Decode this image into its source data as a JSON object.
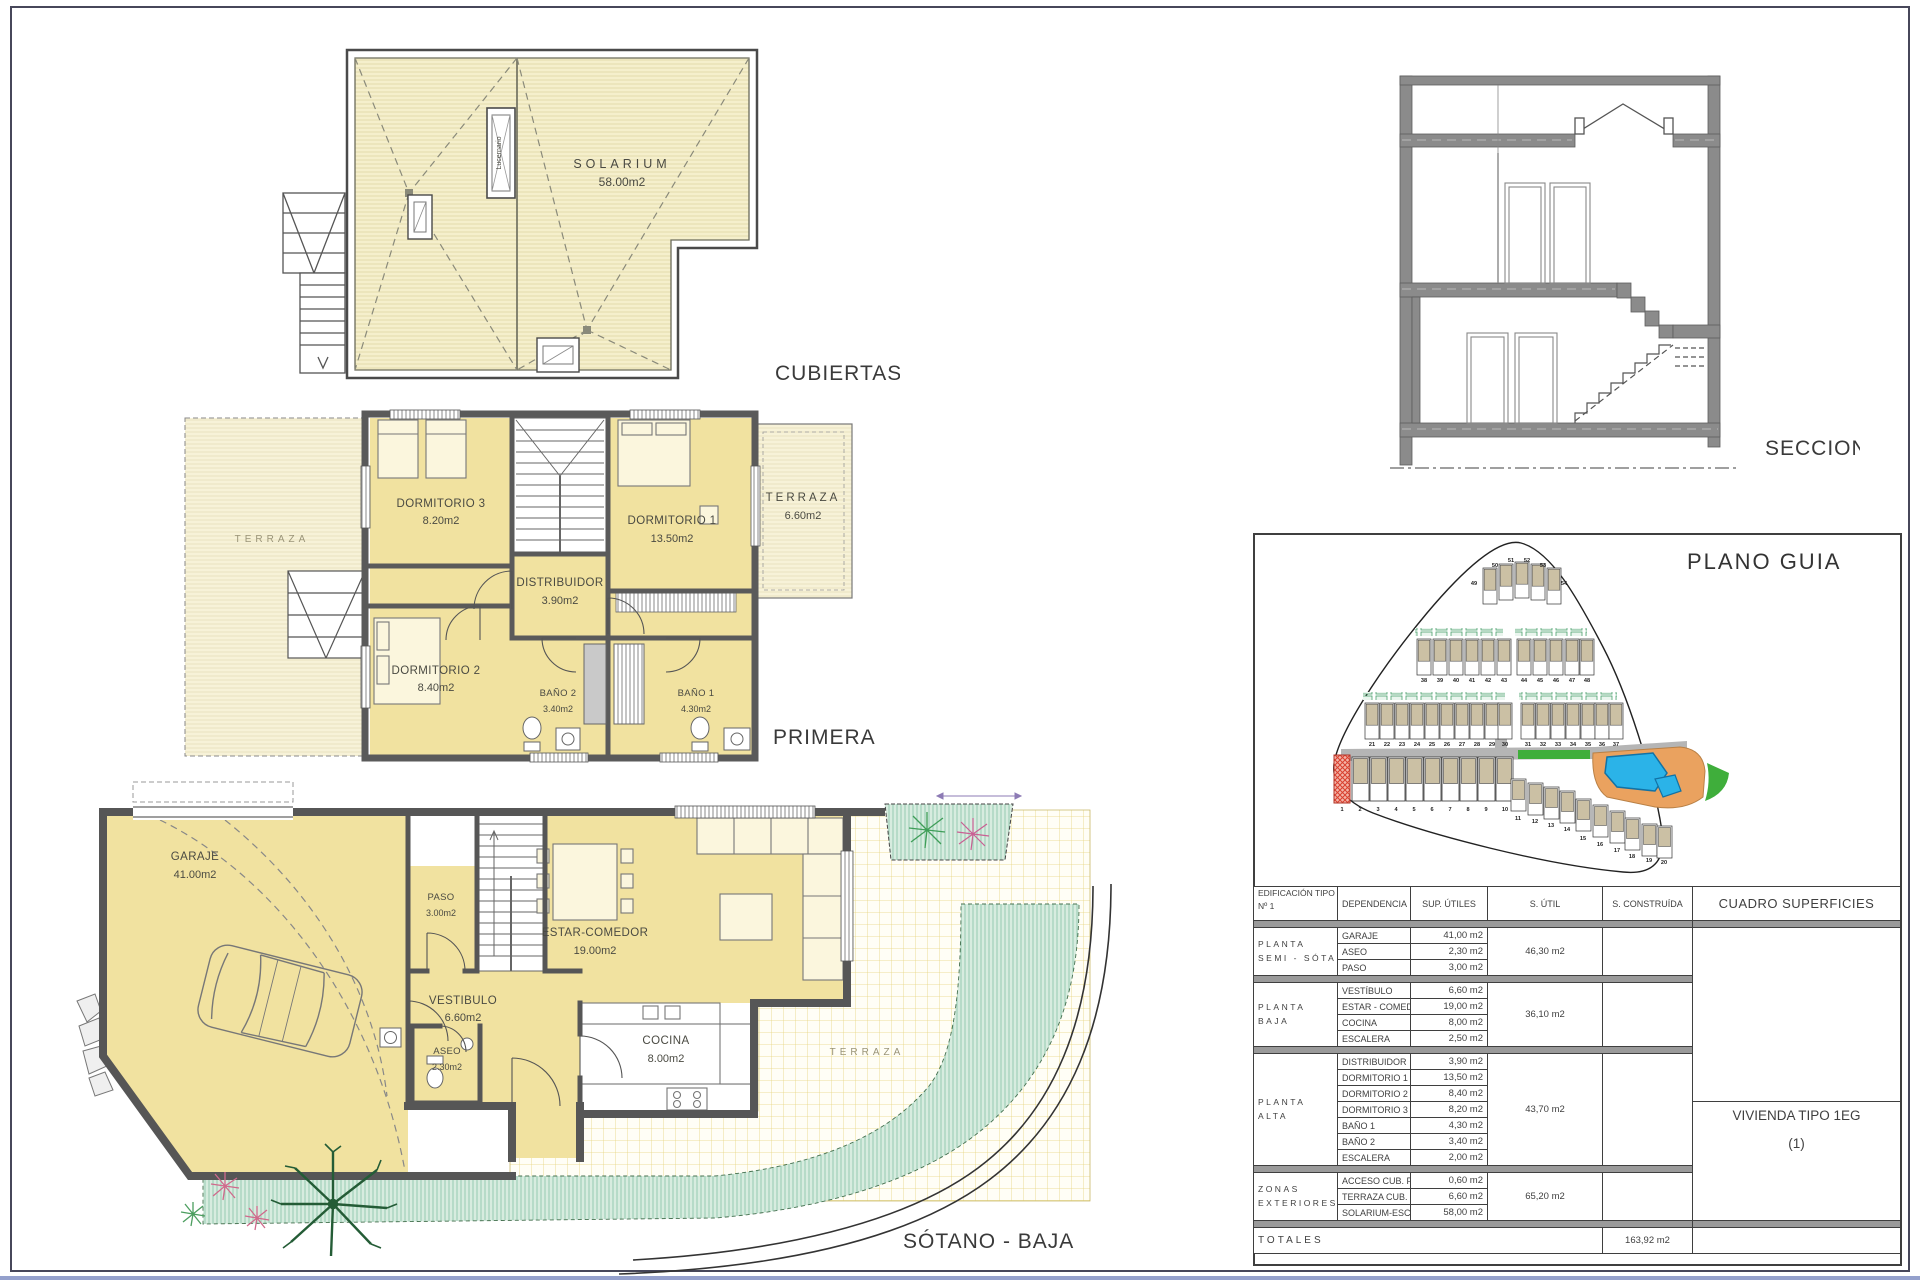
{
  "plans": {
    "cubiertas": {
      "label": "CUBIERTAS",
      "solarium": {
        "name": "SOLARIUM",
        "area": "58.00m2"
      },
      "skylight": "Lucernario"
    },
    "primera": {
      "label": "PRIMERA",
      "terraza_izq": "TERRAZA",
      "rooms": [
        {
          "name": "DORMITORIO 3",
          "area": "8.20m2"
        },
        {
          "name": "DORMITORIO 1",
          "area": "13.50m2"
        },
        {
          "name": "TERRAZA",
          "area": "6.60m2"
        },
        {
          "name": "DISTRIBUIDOR",
          "area": "3.90m2"
        },
        {
          "name": "DORMITORIO 2",
          "area": "8.40m2"
        },
        {
          "name": "BAÑO 2",
          "area": "3.40m2"
        },
        {
          "name": "BAÑO 1",
          "area": "4.30m2"
        }
      ]
    },
    "sotano_baja": {
      "label": "SÓTANO - BAJA",
      "terraza": "TERRAZA",
      "rooms": [
        {
          "name": "GARAJE",
          "area": "41.00m2"
        },
        {
          "name": "PASO",
          "area": "3.00m2"
        },
        {
          "name": "ESTAR-COMEDOR",
          "area": "19.00m2"
        },
        {
          "name": "VESTIBULO",
          "area": "6.60m2"
        },
        {
          "name": "ASEO",
          "area": "2.30m2"
        },
        {
          "name": "COCINA",
          "area": "8.00m2"
        }
      ]
    },
    "seccion": {
      "label": "SECCION"
    }
  },
  "plano_guia": {
    "title": "PLANO GUIA",
    "lots": [
      "1",
      "2",
      "3",
      "4",
      "5",
      "6",
      "7",
      "8",
      "9",
      "10",
      "11",
      "12",
      "13",
      "14",
      "15",
      "16",
      "17",
      "18",
      "19",
      "20",
      "21",
      "22",
      "23",
      "24",
      "25",
      "26",
      "27",
      "28",
      "29",
      "30",
      "31",
      "32",
      "33",
      "34",
      "35",
      "36",
      "37",
      "38",
      "39",
      "40",
      "41",
      "42",
      "43",
      "44",
      "45",
      "46",
      "47",
      "48",
      "49",
      "50",
      "51",
      "52",
      "53",
      "54"
    ]
  },
  "table": {
    "headers": {
      "edificacion_line1": "EDIFICACIÓN TIPO 1EG",
      "edificacion_line2": "Nº 1",
      "dependencia": "DEPENDENCIA",
      "sup_utiles": "SUP. ÚTILES",
      "s_util": "S. ÚTIL",
      "s_construida": "S. CONSTRUÍDA",
      "cuadro": "CUADRO SUPERFICIES"
    },
    "groups": [
      {
        "label_line1": "PLANTA",
        "label_line2": "SEMI - SÓTANO",
        "s_util": "46,30 m2",
        "rows": [
          {
            "name": "GARAJE",
            "value": "41,00 m2"
          },
          {
            "name": "ASEO",
            "value": "2,30 m2"
          },
          {
            "name": "PASO",
            "value": "3,00 m2"
          }
        ]
      },
      {
        "label_line1": "PLANTA",
        "label_line2": "BAJA",
        "s_util": "36,10 m2",
        "rows": [
          {
            "name": "VESTÍBULO",
            "value": "6,60 m2"
          },
          {
            "name": "ESTAR - COMEDOR",
            "value": "19,00 m2"
          },
          {
            "name": "COCINA",
            "value": "8,00 m2"
          },
          {
            "name": "ESCALERA",
            "value": "2,50 m2"
          }
        ]
      },
      {
        "label_line1": "PLANTA",
        "label_line2": "ALTA",
        "s_util": "43,70 m2",
        "rows": [
          {
            "name": "DISTRIBUIDOR",
            "value": "3,90 m2"
          },
          {
            "name": "DORMITORIO 1",
            "value": "13,50 m2"
          },
          {
            "name": "DORMITORIO 2",
            "value": "8,40 m2"
          },
          {
            "name": "DORMITORIO 3",
            "value": "8,20 m2"
          },
          {
            "name": "BAÑO 1",
            "value": "4,30 m2"
          },
          {
            "name": "BAÑO 2",
            "value": "3,40 m2"
          },
          {
            "name": "ESCALERA",
            "value": "2,00 m2"
          }
        ]
      },
      {
        "label_line1": "ZONAS",
        "label_line2": "EXTERIORES",
        "s_util": "65,20 m2",
        "rows": [
          {
            "name": "ACCESO CUB. PB",
            "value": "0,60 m2"
          },
          {
            "name": "TERRAZA CUB. PA",
            "value": "6,60 m2"
          },
          {
            "name": "SOLARIUM-ESCAL.",
            "value": "58,00 m2"
          }
        ]
      }
    ],
    "vivienda_line1": "VIVIENDA TIPO 1EG",
    "vivienda_line2": "(1)",
    "totales_label": "TOTALES",
    "totales_construida": "163,92 m2"
  },
  "colors": {
    "room_yellow": "#f1e2a0",
    "roof_yellow": "#f5efcc",
    "wall_gray": "#5a5a5a",
    "terrace_green": "#d7ecdf",
    "lawn_green": "#3fae3b",
    "pool_blue": "#2bb3e8",
    "deck_orange": "#eaa25f",
    "highlight_red": "#d9402f"
  }
}
